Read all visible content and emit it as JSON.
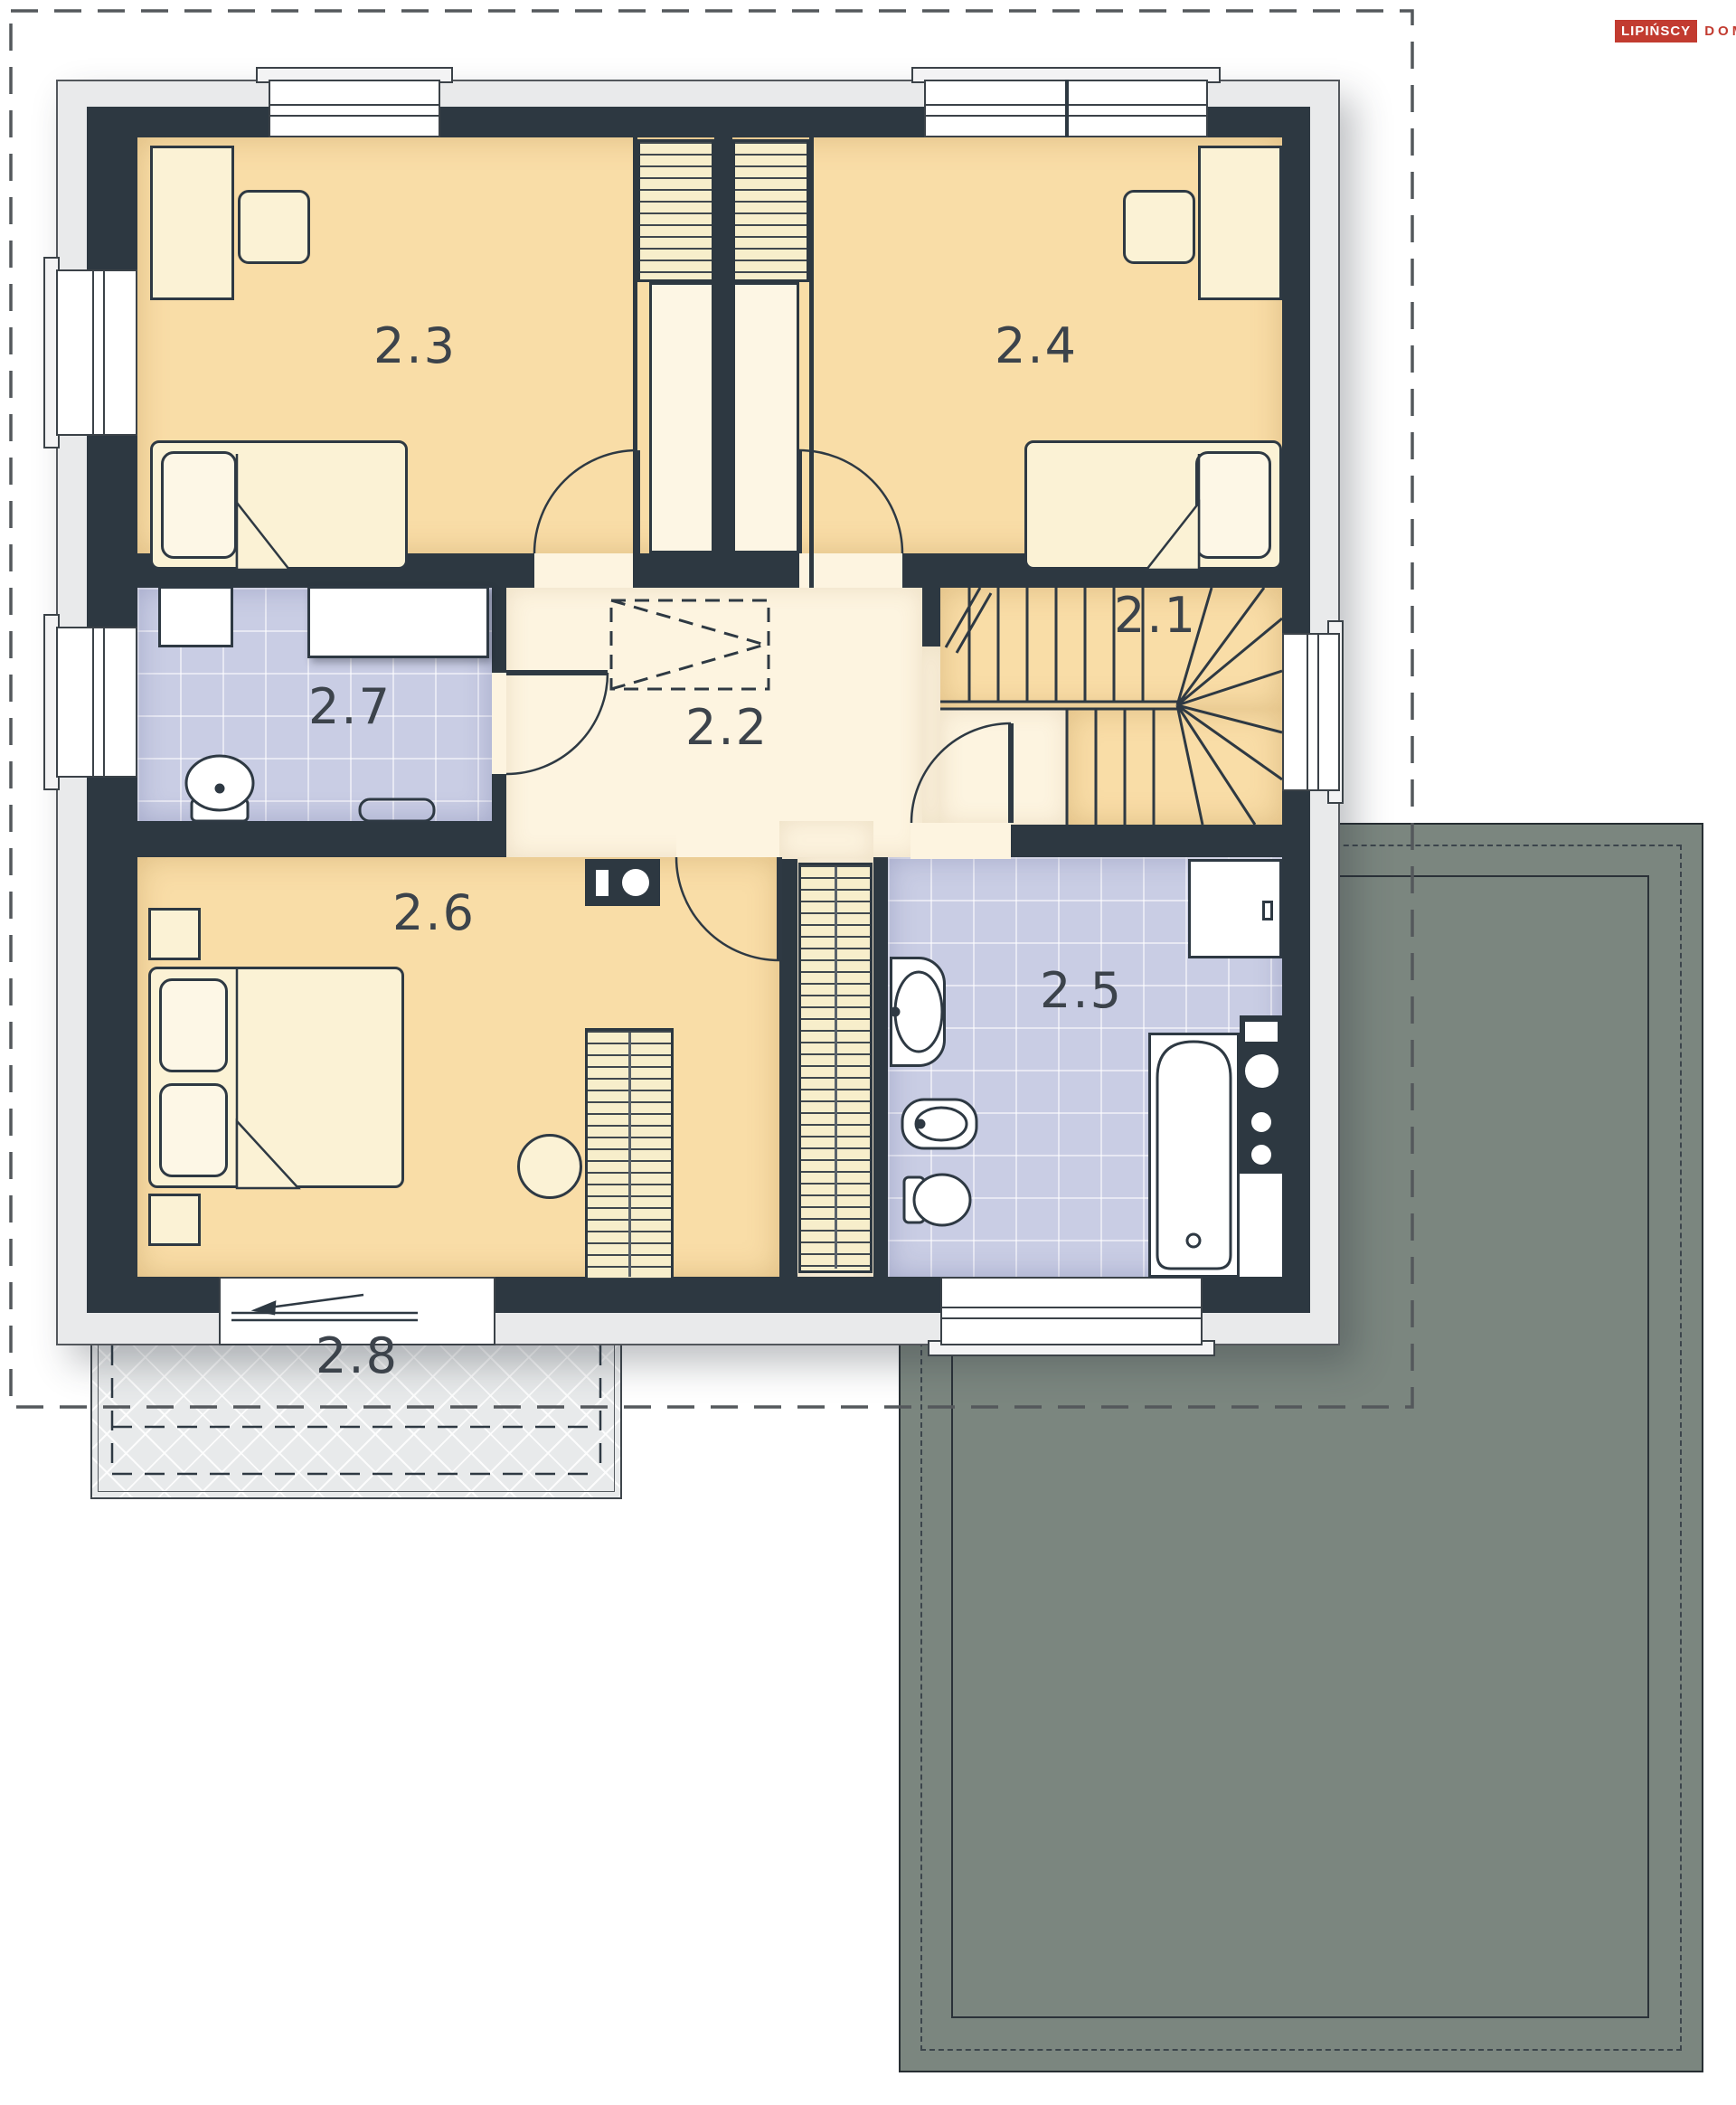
{
  "plan": {
    "type": "floor-plan",
    "floor": "upper storey",
    "rooms": [
      {
        "label": "2.1",
        "name": "staircase"
      },
      {
        "label": "2.2",
        "name": "hallway"
      },
      {
        "label": "2.3",
        "name": "bedroom-left"
      },
      {
        "label": "2.4",
        "name": "bedroom-right"
      },
      {
        "label": "2.5",
        "name": "bathroom-large"
      },
      {
        "label": "2.6",
        "name": "master-bedroom"
      },
      {
        "label": "2.7",
        "name": "bathroom-small"
      },
      {
        "label": "2.8",
        "name": "balcony"
      }
    ]
  },
  "logo": {
    "primary": "LIPIŃSCY",
    "secondary": "DOMY"
  },
  "colors": {
    "wall": "#2d3841",
    "bedroom_floor": "#f9dda7",
    "hall_floor": "#fdf4e0",
    "bathroom_tile": "#c9cde4",
    "garage_roof": "#7b867f",
    "balcony": "#e8eaeb",
    "shell": "#e9eaeb",
    "brand_red": "#c23b30",
    "outline_dash": "#54585c"
  }
}
